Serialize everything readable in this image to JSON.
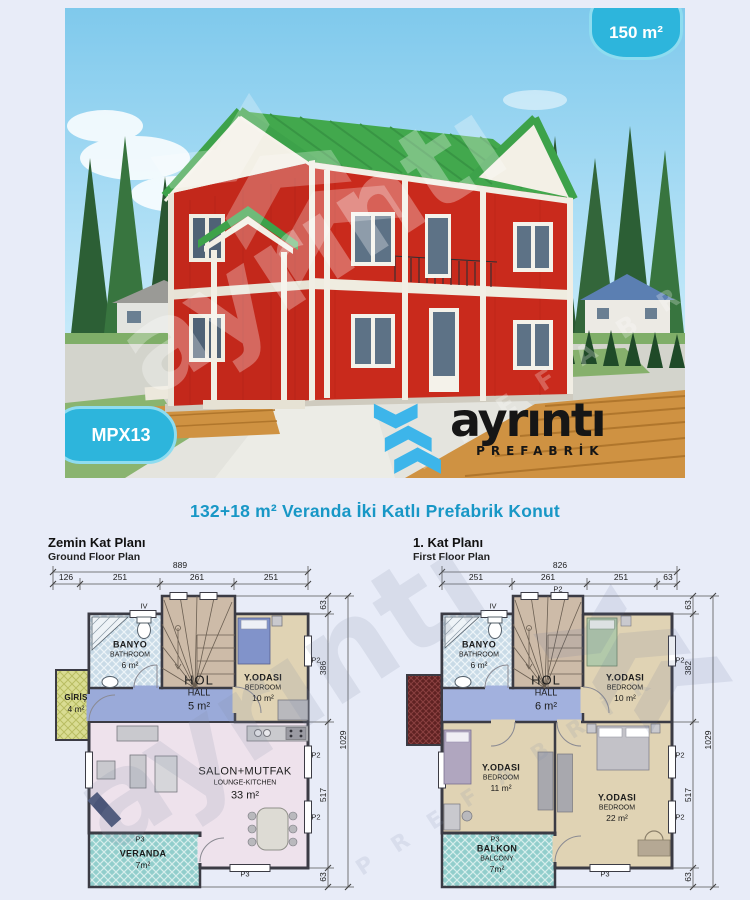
{
  "page": {
    "title": "132+18 m² Veranda İki Katlı Prefabrik Konut"
  },
  "photo": {
    "size_badge": "150 m²",
    "model_badge": "MPX13"
  },
  "logo": {
    "text": "ayrıntı",
    "subtext": "PREFABRİK"
  },
  "watermark": {
    "text": "ayrıntı",
    "subtext": "P R E F A B R İ K"
  },
  "markers": {
    "window": "IV",
    "p2": "P2",
    "p3": "P3"
  },
  "colors": {
    "accent_cyan": "#2db5dc",
    "title_teal": "#1897c6",
    "logo_blue": "#3db5ea",
    "house_red": "#c5291c",
    "roof_green": "#42a84d"
  },
  "plans": {
    "ground": {
      "title_tr": "Zemin Kat Planı",
      "title_en": "Ground Floor Plan",
      "dims": {
        "overall_w": "889",
        "top": [
          "126",
          "251",
          "261",
          "251"
        ],
        "side": [
          "63",
          "386",
          "517",
          "63"
        ],
        "overall_h": "1029"
      },
      "rooms": {
        "banyo": {
          "tr": "BANYO",
          "en": "BATHROOM",
          "area": "6 m²"
        },
        "giris": {
          "tr": "GİRİŞ",
          "area": "4 m²"
        },
        "hol": {
          "tr": "HOL",
          "en": "HALL",
          "area": "5 m²"
        },
        "yodasi": {
          "tr": "Y.ODASI",
          "en": "BEDROOM",
          "area": "10 m²"
        },
        "salon": {
          "tr": "SALON+MUTFAK",
          "en": "LOUNGE-KITCHEN",
          "area": "33 m²"
        },
        "veranda": {
          "tr": "VERANDA",
          "area": "7m²"
        }
      }
    },
    "first": {
      "title_tr": "1. Kat Planı",
      "title_en": "First Floor Plan",
      "dims": {
        "overall_w": "826",
        "top": [
          "251",
          "261",
          "251",
          "63"
        ],
        "side": [
          "63",
          "382",
          "517",
          "63"
        ],
        "overall_h": "1029"
      },
      "rooms": {
        "banyo": {
          "tr": "BANYO",
          "en": "BATHROOM",
          "area": "6 m²"
        },
        "hol": {
          "tr": "HOL",
          "en": "HALL",
          "area": "6 m²"
        },
        "yodasi10": {
          "tr": "Y.ODASI",
          "en": "BEDROOM",
          "area": "10 m²"
        },
        "yodasi11": {
          "tr": "Y.ODASI",
          "en": "BEDROOM",
          "area": "11 m²"
        },
        "yodasi22": {
          "tr": "Y.ODASI",
          "en": "BEDROOM",
          "area": "22 m²"
        },
        "balkon": {
          "tr": "BALKON",
          "en": "BALCONY",
          "area": "7m²"
        }
      }
    }
  }
}
